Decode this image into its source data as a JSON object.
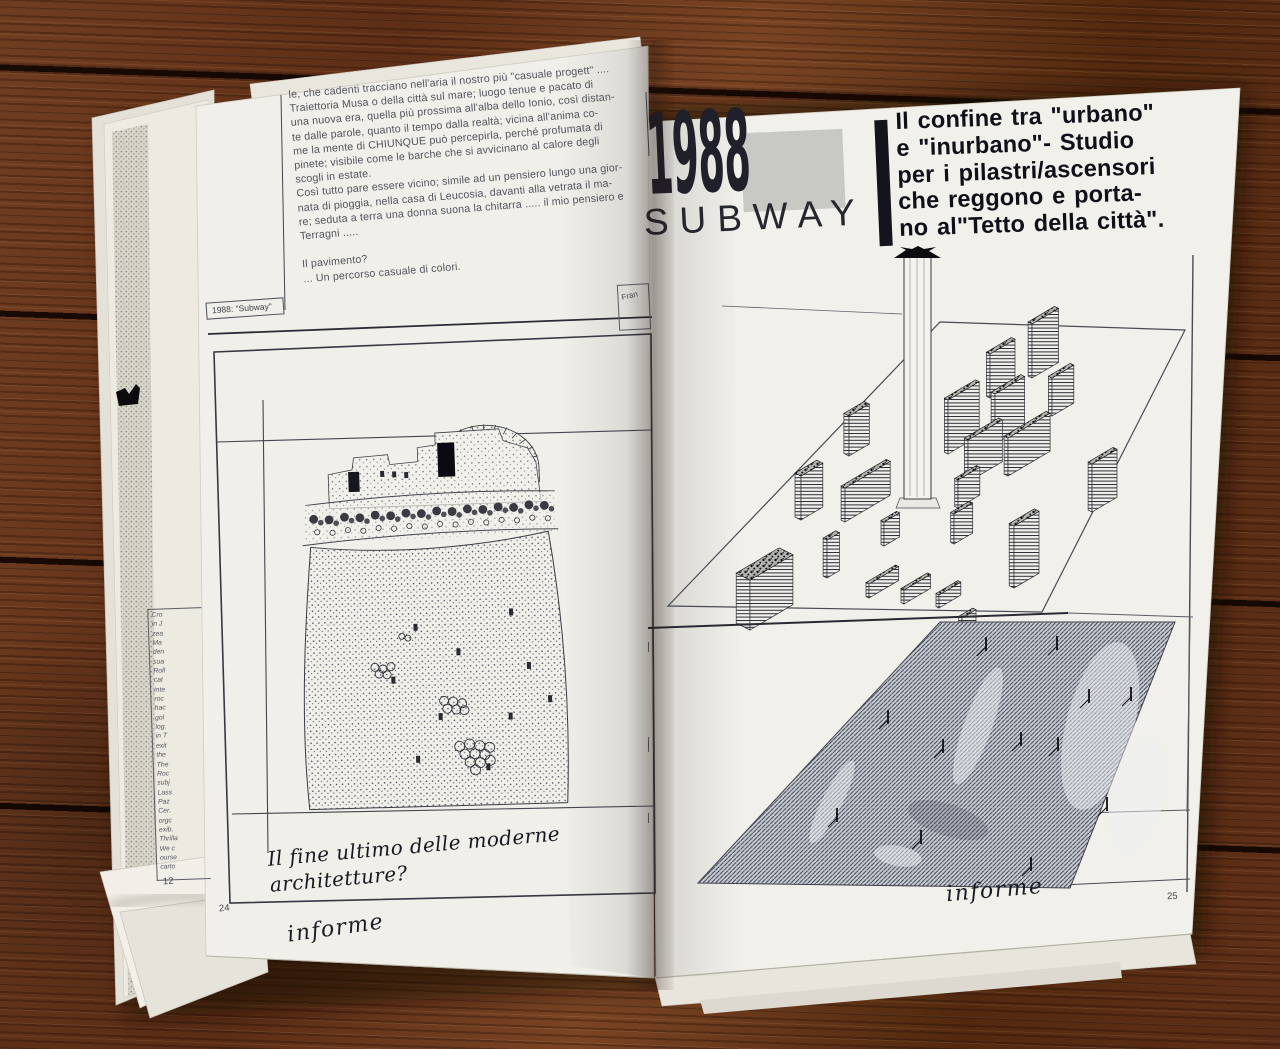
{
  "book": {
    "left_page": {
      "page_number": "24",
      "article_lines": [
        "le, che cadenti tracciano nell'aria il nostro più \"casuale progett\" ....",
        "Traiettoria Musa  o della città sul mare; luogo tenue e pacato di",
        "una nuova era, quella più prossima all'alba dello Ionio, così distan-",
        "te dalle parole, quanto il tempo dalla realtà; vicina all'anima co-",
        "me la mente di CHIUNQUE può percepirla, perché profumata di",
        "pinete; visibile come le barche che si avvicinano al calore degli",
        "scogli in estate.",
        "Così tutto pare essere vicino; simile ad un pensiero lungo una gior-",
        "nata di pioggia, nella casa di Leucosia, davanti alla vetrata il ma-",
        "re; seduta a terra una donna suona la chitarra ..... il mio pensiero e",
        "Terragni .....",
        "",
        "Il pavimento?",
        "... Un percorso casuale di colori."
      ],
      "caption": "1988: \"Subway\"",
      "side_label": "Fran",
      "handwriting": "Il fine ultimo delle moderne architetture?",
      "signature": "informe"
    },
    "right_page": {
      "page_number": "25",
      "header": {
        "year": "1988",
        "word": "SUBWAY",
        "title_lines": [
          "Il confine tra \"urbano\"",
          "e \"inurbano\"- Studio",
          "per i pilastri/ascensori",
          "che reggono e porta-",
          "no al\"Tetto della città\"."
        ]
      },
      "signature": "informe"
    },
    "under_page": {
      "page_number": "12",
      "margin_fragments": [
        "Cro",
        "in J",
        "zea",
        "Ma",
        "den",
        "sua",
        "Roll",
        "cat",
        "inte",
        "roc",
        "hac",
        "gol",
        "log.",
        "in T",
        "exit",
        "the",
        "The",
        "Roc",
        "subj",
        "Lass",
        "Paz",
        "Cer.",
        "orgc",
        "exib.",
        "Thrilla",
        "We c",
        "ourse",
        "carto"
      ]
    }
  }
}
